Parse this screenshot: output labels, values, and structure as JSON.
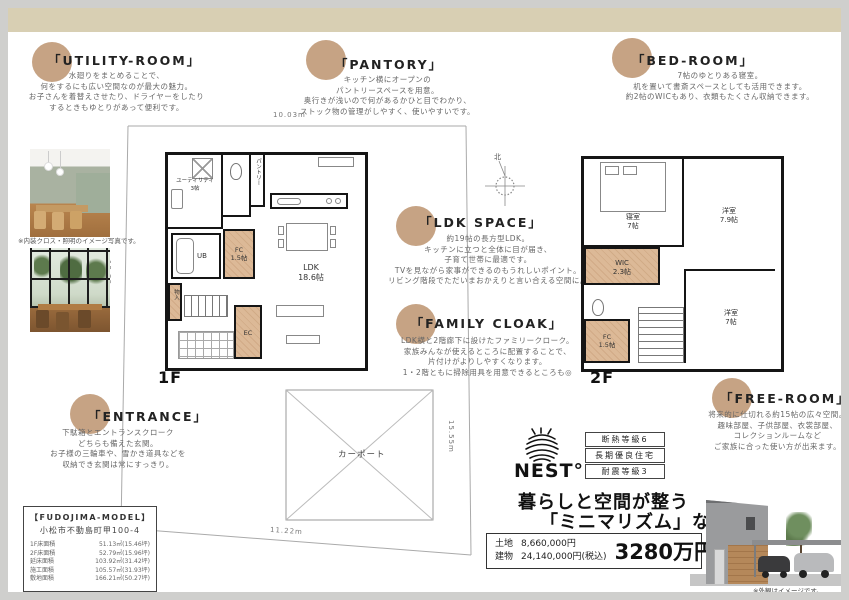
{
  "sections": {
    "utility": {
      "title": "「UTILITY-ROOM」",
      "lines": [
        "水廻りをまとめることで、",
        "何をするにも広い空間なのが最大の魅力。",
        "お子さんを着替えさせたり、ドライヤーをしたり",
        "するときもゆとりがあって便利です。"
      ]
    },
    "pantory": {
      "title": "「PANTORY」",
      "lines": [
        "キッチン横にオープンの",
        "パントリースペースを用意。",
        "奥行きが浅いので何があるかひと目でわかり、",
        "ストック物の管理がしやすく、使いやすいです。"
      ]
    },
    "bedroom": {
      "title": "「BED-ROOM」",
      "lines": [
        "7帖のゆとりある寝室。",
        "机を置いて書斎スペースとしても活用できます。",
        "約2帖のWICもあり、衣類もたくさん収納できます。"
      ]
    },
    "ldk": {
      "title": "「LDK SPACE」",
      "lines": [
        "約19帖の長方型LDK。",
        "キッチンに立つと全体に目が届き、",
        "子育て世帯に最適です。",
        "TVを見ながら家事ができるのもうれしいポイント。",
        "リビング階段でただいまおかえりと言い合える空間に。"
      ]
    },
    "family_cloak": {
      "title": "「FAMILY CLOAK」",
      "lines": [
        "LDK横と2階廊下に設けたファミリークローク。",
        "家族みんなが使えるところに配置することで、",
        "片付けがよりしやすくなります。",
        "1・2階ともに掃除用具を用意できるところも◎"
      ]
    },
    "free_room": {
      "title": "「FREE-ROOM」",
      "lines": [
        "将来的に仕切れる約15帖の広々空間。",
        "趣味部屋、子供部屋、衣裳部屋、",
        "コレクションルームなど",
        "ご家族に合った使い方が出来ます。"
      ]
    },
    "entrance": {
      "title": "「ENTRANCE」",
      "lines": [
        "下駄箱とエントランスクローク",
        "どちらも備えた玄関。",
        "お子様の三輪車や、雪かき道具などを",
        "収納でき玄関は常にすっきり。"
      ]
    }
  },
  "plan1f": {
    "floor_label": "1F",
    "utility_name": "ユーティリティ",
    "utility_size": "3帖",
    "pantry": "パントリー",
    "ub": "UB",
    "fc_name": "FC",
    "fc_size": "1.5帖",
    "ldk_name": "LDK",
    "ldk_size": "18.6帖",
    "ec": "EC",
    "closet": "物入"
  },
  "plan2f": {
    "floor_label": "2F",
    "bedroom_name": "寝室",
    "bedroom_size": "7帖",
    "western1_name": "洋室",
    "western1_size": "7.9帖",
    "wic_name": "WIC",
    "wic_size": "2.3帖",
    "western2_name": "洋室",
    "western2_size": "7帖",
    "fc_name": "FC",
    "fc_size": "1.5帖"
  },
  "site": {
    "dim_top": "10.03m",
    "dim_left": "12.29m",
    "dim_right": "15.55m",
    "dim_bottom": "11.22m",
    "carport": "カーポート",
    "north": "北"
  },
  "photos": {
    "caption": "※内装クロス・照明のイメージ写真です。"
  },
  "model_info": {
    "title": "【FUDOJIMA-MODEL】",
    "address": "小松市不動島町甲100-4",
    "rows": [
      {
        "label": "1F床面積",
        "value": "51.13㎡(15.46坪)"
      },
      {
        "label": "2F床面積",
        "value": "52.79㎡(15.96坪)"
      },
      {
        "label": "延床面積",
        "value": "103.92㎡(31.42坪)"
      },
      {
        "label": "施工面積",
        "value": "105.57㎡(31.93坪)"
      },
      {
        "label": "敷地面積",
        "value": "166.21㎡(50.27坪)"
      }
    ]
  },
  "branding": {
    "logo": "NEST°",
    "badges": [
      "断熱等級6",
      "長期優良住宅",
      "耐震等級3"
    ],
    "tagline1": "暮らしと空間が整う",
    "tagline2": "「ミニマリズム」な家"
  },
  "price": {
    "land_label": "土地",
    "land_value": "8,660,000円",
    "building_label": "建物",
    "building_value": "24,140,000円(税込)",
    "total": "3280万円"
  },
  "exterior": {
    "caption": "※外観はイメージです。"
  },
  "colors": {
    "accent_circle": "#c6a384",
    "tan_room": "#dcb997",
    "bottom_strip": "#d8cfb3"
  }
}
